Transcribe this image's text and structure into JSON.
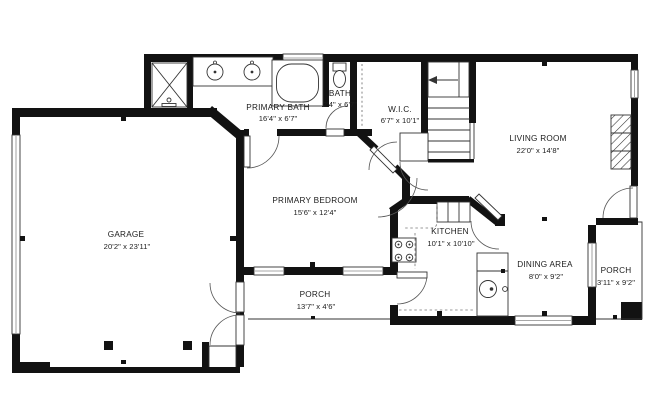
{
  "meta": {
    "type": "residential-floor-plan",
    "background_color": "#ffffff",
    "wall_color": "#121212",
    "line_color": "#333333"
  },
  "floorplan": {
    "rooms": [
      {
        "id": "primary-bath",
        "name": "PRIMARY BATH",
        "dims": "16'4\" x 6'7\""
      },
      {
        "id": "bath",
        "name": "BATH",
        "dims": "2'4\" x 6'7\""
      },
      {
        "id": "wic",
        "name": "W.I.C.",
        "dims": "6'7\" x 10'1\""
      },
      {
        "id": "living-room",
        "name": "LIVING ROOM",
        "dims": "22'0\" x 14'8\""
      },
      {
        "id": "primary-bedroom",
        "name": "PRIMARY BEDROOM",
        "dims": "15'6\" x 12'4\""
      },
      {
        "id": "garage",
        "name": "GARAGE",
        "dims": "20'2\" x 23'11\""
      },
      {
        "id": "kitchen",
        "name": "KITCHEN",
        "dims": "10'1\" x 10'10\""
      },
      {
        "id": "dining-area",
        "name": "DINING AREA",
        "dims": "8'0\" x 9'2\""
      },
      {
        "id": "porch-rear",
        "name": "PORCH",
        "dims": "13'7\" x 4'6\""
      },
      {
        "id": "porch-side",
        "name": "PORCH",
        "dims": "3'11\" x 9'2\""
      }
    ],
    "fixtures": [
      "shower",
      "double-vanity",
      "bathtub",
      "toilet",
      "staircase",
      "fireplace",
      "range",
      "kitchen-sink",
      "pantry",
      "garage-posts",
      "windows",
      "door-swings",
      "garage-door"
    ]
  }
}
